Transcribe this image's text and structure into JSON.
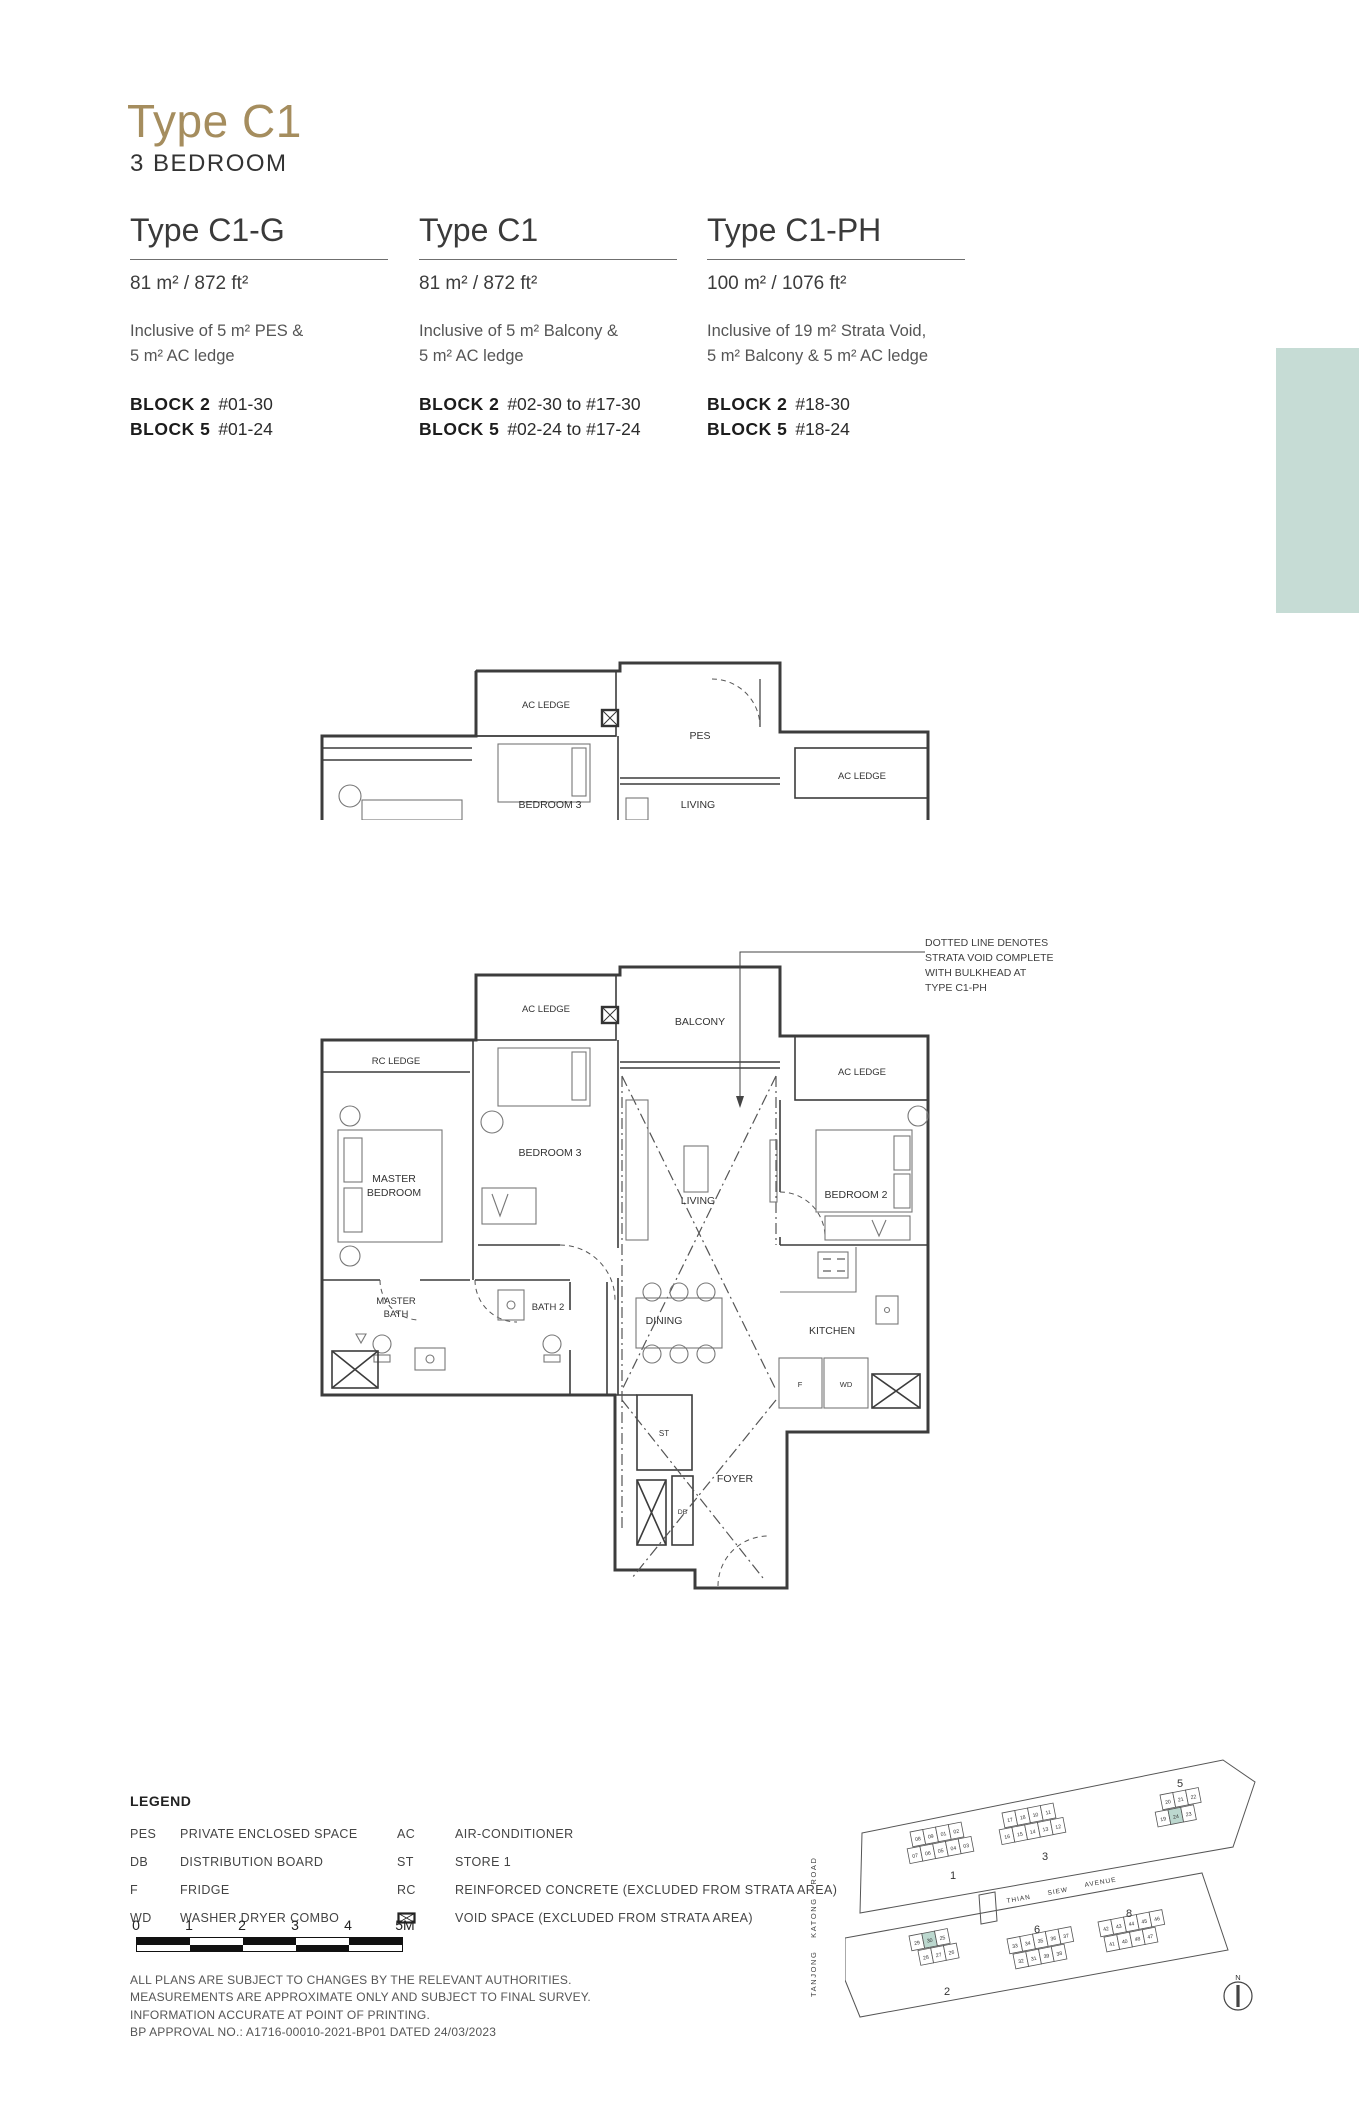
{
  "header": {
    "title": "Type C1",
    "subtitle": "3 BEDROOM"
  },
  "accent_colors": {
    "gold": "#a58d5e",
    "teal_panel": "#c6dcd5",
    "teal_unit_highlight": "#bcd8cf"
  },
  "variants": [
    {
      "name": "Type C1-G",
      "area": "81 m² / 872 ft²",
      "inclusive_line1": "Inclusive of 5 m² PES &",
      "inclusive_line2": "5 m² AC ledge",
      "blocks": [
        {
          "label": "BLOCK 2",
          "units": "#01-30"
        },
        {
          "label": "BLOCK 5",
          "units": "#01-24"
        }
      ]
    },
    {
      "name": "Type C1",
      "area": "81 m² / 872 ft²",
      "inclusive_line1": "Inclusive of 5 m² Balcony &",
      "inclusive_line2": "5 m² AC ledge",
      "blocks": [
        {
          "label": "BLOCK 2",
          "units": "#02-30 to #17-30"
        },
        {
          "label": "BLOCK 5",
          "units": "#02-24 to #17-24"
        }
      ]
    },
    {
      "name": "Type C1-PH",
      "area": "100 m² / 1076 ft²",
      "inclusive_line1": "Inclusive of 19 m² Strata Void,",
      "inclusive_line2": "5 m² Balcony & 5 m² AC ledge",
      "blocks": [
        {
          "label": "BLOCK 2",
          "units": "#18-30"
        },
        {
          "label": "BLOCK 5",
          "units": "#18-24"
        }
      ]
    }
  ],
  "annotation": {
    "line1": "DOTTED LINE DENOTES",
    "line2": "STRATA VOID COMPLETE",
    "line3": "WITH BULKHEAD AT",
    "line4": "TYPE C1-PH"
  },
  "plan_labels": {
    "rc_ledge": "RC LEDGE",
    "ac_ledge_left": "AC LEDGE",
    "balcony": "BALCONY",
    "pes": "PES",
    "ac_ledge_right": "AC LEDGE",
    "master_bedroom_1": "MASTER",
    "master_bedroom_2": "BEDROOM",
    "bedroom3": "BEDROOM 3",
    "bedroom2": "BEDROOM 2",
    "living": "LIVING",
    "master_bath_1": "MASTER",
    "master_bath_2": "BATH",
    "bath2": "BATH 2",
    "dining": "DINING",
    "kitchen": "KITCHEN",
    "foyer": "FOYER",
    "f": "F",
    "wd": "WD",
    "st": "ST",
    "db": "DB"
  },
  "legend": {
    "title": "LEGEND",
    "col1": [
      {
        "abbr": "PES",
        "desc": "PRIVATE ENCLOSED SPACE"
      },
      {
        "abbr": "DB",
        "desc": "DISTRIBUTION BOARD"
      },
      {
        "abbr": "F",
        "desc": "FRIDGE"
      },
      {
        "abbr": "WD",
        "desc": "WASHER DRYER COMBO"
      }
    ],
    "col2": [
      {
        "abbr": "AC",
        "desc": "AIR-CONDITIONER"
      },
      {
        "abbr": "ST",
        "desc": "STORE 1"
      },
      {
        "abbr": "RC",
        "desc": "REINFORCED CONCRETE (EXCLUDED FROM STRATA AREA)"
      },
      {
        "abbr": "",
        "desc": "VOID SPACE (EXCLUDED FROM STRATA AREA)"
      }
    ]
  },
  "scalebar": {
    "labels": [
      "0",
      "1",
      "2",
      "3",
      "4",
      "5M"
    ]
  },
  "disclaimer": {
    "line1": "ALL PLANS ARE SUBJECT TO CHANGES BY THE RELEVANT AUTHORITIES.",
    "line2": "MEASUREMENTS ARE APPROXIMATE ONLY AND SUBJECT TO FINAL SURVEY.",
    "line3": "INFORMATION ACCURATE AT POINT OF PRINTING.",
    "line4": "BP APPROVAL NO.: A1716-00010-2021-BP01 DATED 24/03/2023"
  },
  "siteplan": {
    "road_word1": "THIAN",
    "road_word2": "SIEW",
    "road_word3": "AVENUE",
    "road_vertical": "TANJONG KATONG ROAD",
    "north_label": "N",
    "highlighted_units": [
      "24",
      "30"
    ],
    "block1": {
      "label": "1",
      "top": [
        "08",
        "09",
        "01",
        "02"
      ],
      "bottom": [
        "07",
        "06",
        "05",
        "04",
        "03"
      ]
    },
    "block3": {
      "label": "3",
      "top": [
        "17",
        "18",
        "10",
        "11"
      ],
      "bottom": [
        "16",
        "15",
        "14",
        "13",
        "12"
      ]
    },
    "block5": {
      "label": "5",
      "top": [
        "20",
        "21",
        "22"
      ],
      "bottom": [
        "19",
        "24",
        "23"
      ]
    },
    "block2": {
      "label": "2",
      "top": [
        "29",
        "30",
        "25"
      ],
      "bottom": [
        "28",
        "27",
        "26"
      ]
    },
    "block6": {
      "label": "6",
      "top": [
        "33",
        "34",
        "35",
        "36",
        "37"
      ],
      "bottom": [
        "32",
        "31",
        "39",
        "38"
      ]
    },
    "block8": {
      "label": "8",
      "top": [
        "42",
        "43",
        "44",
        "45",
        "46"
      ],
      "bottom": [
        "41",
        "40",
        "48",
        "47"
      ]
    }
  }
}
